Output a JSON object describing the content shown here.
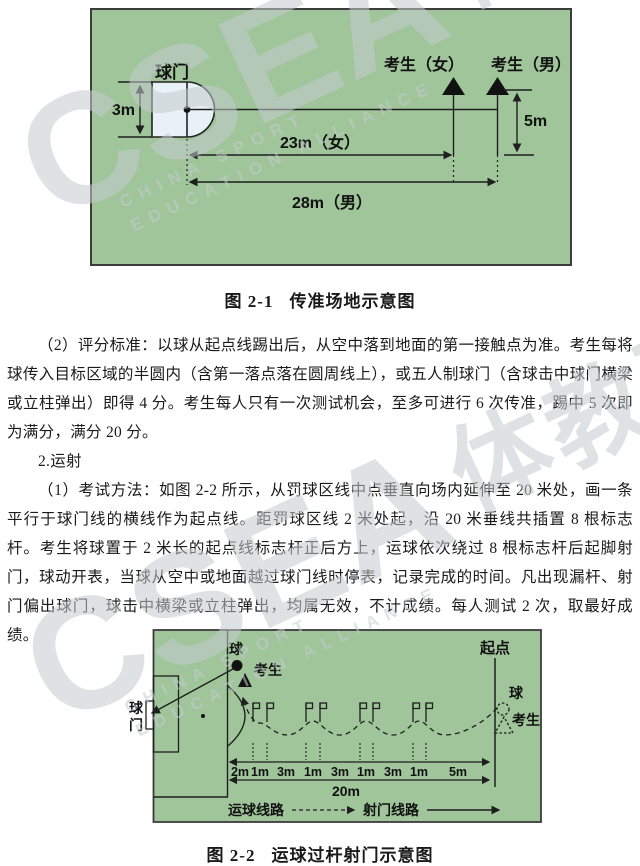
{
  "watermark": {
    "csea": "CSEA",
    "brand": "体教联盟APP",
    "small1": "CHINA  SPORT",
    "small2": "EDUCATION  ALLIANCE"
  },
  "figure1": {
    "caption_num": "图 2-1",
    "caption_title": "传准场地示意图",
    "goal_label": "球门",
    "goal_height": "3m",
    "examinee_female": "考生（女）",
    "examinee_male": "考生（男）",
    "dist_female": "23m（女）",
    "dist_male": "28m（男）",
    "offset_5m": "5m"
  },
  "body": {
    "p1": "（2）评分标准：以球从起点线踢出后，从空中落到地面的第一接触点为准。考生每将球传入目标区域的半圆内（含第一落点落在圆周线上），或五人制球门（含球击中球门横梁或立柱弹出）即得 4 分。考生每人只有一次测试机会，至多可进行 6 次传准，踢中 5 次即为满分，满分 20 分。",
    "p2": "2.运射",
    "p3": "（1）考试方法：如图 2-2 所示，从罚球区线中点垂直向场内延伸至 20 米处，画一条平行于球门线的横线作为起点线。距罚球区线 2 米处起，沿 20 米垂线共插置 8 根标志杆。考生将球置于 2 米长的起点线标志杆正后方上，运球依次绕过 8 根标志杆后起脚射门，球动开表，当球从空中或地面越过球门线时停表，记录完成的时间。凡出现漏杆、射门偏出球门，球击中横梁或立柱弹出，均属无效，不计成绩。每人测试 2 次，取最好成绩。"
  },
  "figure2": {
    "caption_num": "图 2-2",
    "caption_title": "运球过杆射门示意图",
    "goal_vertical": [
      "球",
      "门"
    ],
    "ball_label": "球",
    "examinee_label": "考生",
    "start_label": "起点",
    "start_ball_label": "球",
    "start_examinee_label": "考生",
    "segments": [
      "2m",
      "1m",
      "3m",
      "1m",
      "3m",
      "1m",
      "3m",
      "1m",
      "5m"
    ],
    "total": "20m",
    "legend_dribble": "运球线路",
    "legend_shoot": "射门线路"
  },
  "colors": {
    "field_green": "#a0c59b",
    "line_dark": "#1f1f1f",
    "goal_fill": "#e8f2f6",
    "watermark_gray": "#c6cbce"
  }
}
